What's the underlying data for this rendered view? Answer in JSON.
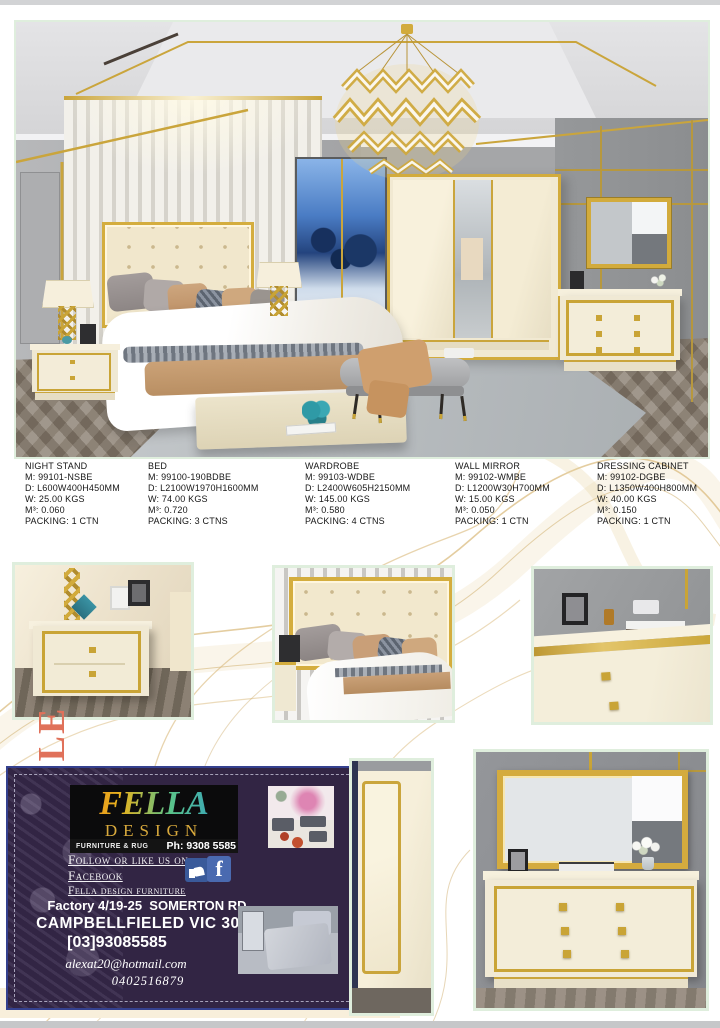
{
  "page": {
    "background": "#ffffff",
    "accent_gold": "#c9a436",
    "photo_border_color": "#dfeedd",
    "top_bar_color": "#d2d3d5",
    "bottom_bar_color": "#c6c7c9"
  },
  "specs": {
    "products": [
      {
        "name": "NIGHT STAND",
        "model": "M: 99101-NSBE",
        "dimensions": "D: L600W400H450MM",
        "weight": "W: 25.00 KGS",
        "volume": "M³: 0.060",
        "packing": "PACKING: 1 CTN"
      },
      {
        "name": "BED",
        "model": "M: 99100-190BDBE",
        "dimensions": "D: L2100W1970H1600MM",
        "weight": "W: 74.00 KGS",
        "volume": "M³: 0.720",
        "packing": "PACKING: 3 CTNS"
      },
      {
        "name": "WARDROBE",
        "model": "M: 99103-WDBE",
        "dimensions": "D: L2400W605H2150MM",
        "weight": "W: 145.00 KGS",
        "volume": "M³: 0.580",
        "packing": "PACKING: 4 CTNS"
      },
      {
        "name": "WALL MIRROR",
        "model": "M: 99102-WMBE",
        "dimensions": "D: L1200W30H700MM",
        "weight": "W: 15.00 KGS",
        "volume": "M³: 0.050",
        "packing": "PACKING: 1 CTN"
      },
      {
        "name": "DRESSING CABINET",
        "model": "M: 99102-DGBE",
        "dimensions": "D: L1350W400H800MM",
        "weight": "W: 40.00 KGS",
        "volume": "M³: 0.150",
        "packing": "PACKING: 1 CTN"
      }
    ]
  },
  "vertical_label": "LE",
  "card": {
    "brand": "FELLA",
    "brand_sub": "DESIGN",
    "tagline": "FURNITURE & RUG",
    "phone": "Ph: 9308 5585",
    "social_line1": "Follow or like us on",
    "social_line2": "Facebook",
    "social_line3": "Fella design furniture",
    "facebook_letter": "f",
    "address_line1": "Factory 4/19-25  SOMERTON RD",
    "address_line2": "CAMPBELLFIELED VIC 3061",
    "phone2": "[03]93085585",
    "email": "alexat20@hotmail.com",
    "mobile": "0402516879",
    "bg_color": "#322544",
    "border_color": "#35418f"
  }
}
